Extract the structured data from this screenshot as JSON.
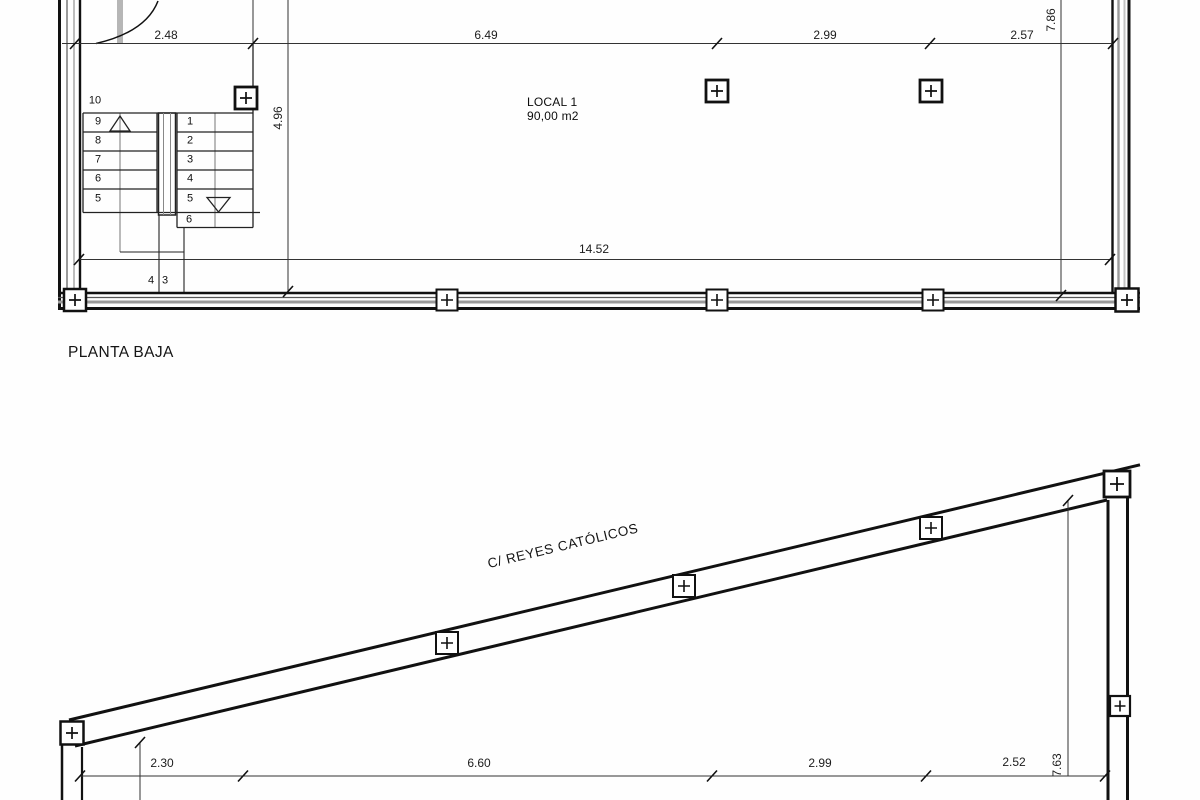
{
  "upper_plan": {
    "title": "PLANTA BAJA",
    "room": {
      "name": "LOCAL 1",
      "area": "90,00 m2"
    },
    "dims_top": [
      "2.48",
      "6.49",
      "2.99",
      "2.57"
    ],
    "dim_total_width": "14.52",
    "dim_stair_depth": "4.96",
    "dim_right_height": "7.86",
    "stairs": {
      "count_label": "10",
      "up_flight": [
        "9",
        "8",
        "7",
        "6",
        "5"
      ],
      "down_flight": [
        "1",
        "2",
        "3",
        "4",
        "5",
        "6"
      ],
      "lower_steps": [
        "4",
        "3"
      ]
    }
  },
  "lower_plan": {
    "street": "C/ REYES CATÓLICOS",
    "dims_bottom": [
      "2.30",
      "6.60",
      "2.99",
      "2.52"
    ],
    "dim_right_height": "7.63"
  },
  "icons": {
    "column_marker": "plus-in-square"
  },
  "colors": {
    "line": "#111111",
    "dim_line": "#333333",
    "wall_gray": "#9a9a9a",
    "door_gray": "#b6b6b6",
    "background": "#ffffff"
  }
}
